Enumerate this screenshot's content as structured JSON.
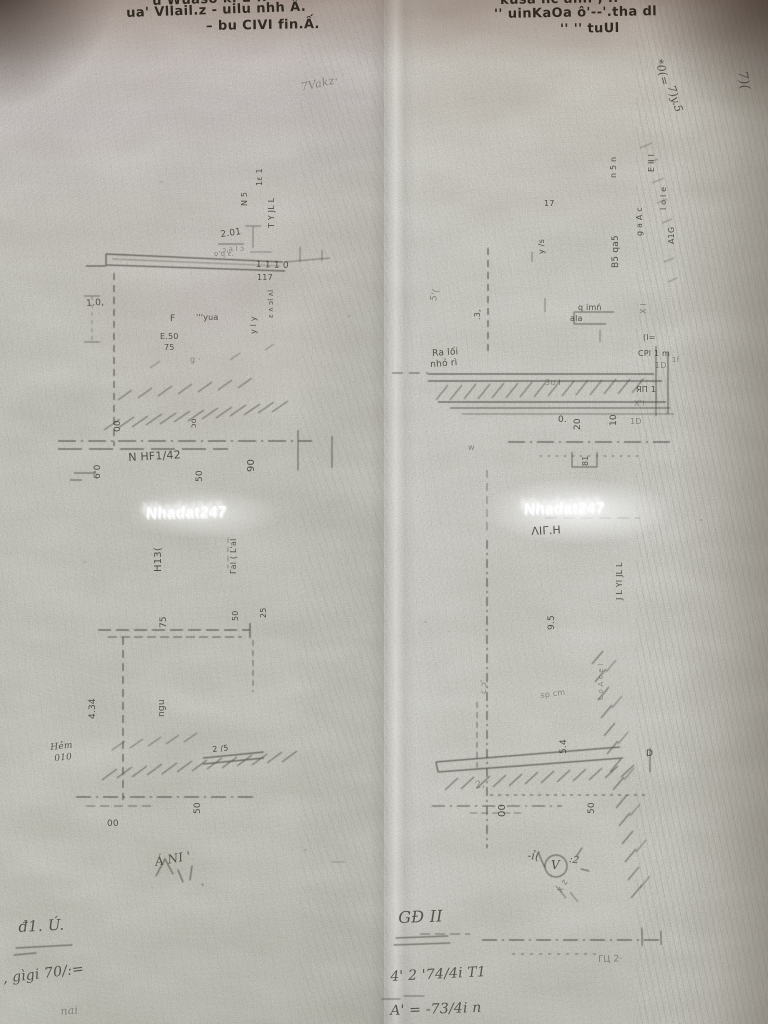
{
  "watermarks": {
    "left": "Nhadat247",
    "right": "Nhadat247"
  },
  "annotations": [
    {
      "name": "header-left-line1",
      "text": "u Wuaso k. 2 ..",
      "x": 152,
      "y": -5,
      "rot": -2,
      "fs": 13,
      "cls": "bold"
    },
    {
      "name": "header-left-line2",
      "text": "ua' Vllail.z - uilu nhh Â.",
      "x": 126,
      "y": 7,
      "rot": -2,
      "fs": 13,
      "cls": "bold"
    },
    {
      "name": "header-left-line3",
      "text": "– bu CIVI fin.Ấ.",
      "x": 206,
      "y": 20,
      "rot": -1,
      "fs": 13,
      "cls": "bold"
    },
    {
      "name": "header-right-line1",
      "text": "kusa nc ani. , ..",
      "x": 500,
      "y": -6,
      "rot": -1,
      "fs": 13,
      "cls": "bold"
    },
    {
      "name": "header-right-line2",
      "text": "'' uinKaOa ô'--'.tha dl",
      "x": 494,
      "y": 8,
      "rot": -1,
      "fs": 13,
      "cls": "bold"
    },
    {
      "name": "header-right-line3",
      "text": "'' '' tuUl",
      "x": 560,
      "y": 23,
      "rot": -1,
      "fs": 13,
      "cls": "bold"
    },
    {
      "name": "faint-scribble-top",
      "text": "7Vakz·",
      "x": 300,
      "y": 82,
      "rot": -12,
      "fs": 11,
      "cls": "hand faint"
    },
    {
      "name": "margin-note-1",
      "text": "*0(=",
      "x": 664,
      "y": 58,
      "rot": 75,
      "fs": 11,
      "cls": "hand"
    },
    {
      "name": "margin-note-2",
      "text": "7)y.5",
      "x": 676,
      "y": 84,
      "rot": 72,
      "fs": 11,
      "cls": "hand"
    },
    {
      "name": "margin-note-3",
      "text": "7)(",
      "x": 748,
      "y": 70,
      "rot": 80,
      "fs": 13,
      "cls": "hand"
    },
    {
      "name": "lt-col-1",
      "text": "1ɛ 1",
      "x": 256,
      "y": 186,
      "rot": -90,
      "fs": 8
    },
    {
      "name": "lt-col-2",
      "text": "T Y JL L",
      "x": 268,
      "y": 228,
      "rot": -90,
      "fs": 8
    },
    {
      "name": "lt-col-3",
      "text": "N 5",
      "x": 241,
      "y": 206,
      "rot": -90,
      "fs": 8
    },
    {
      "name": "lt-dim-201",
      "text": "2.01",
      "x": 220,
      "y": 231,
      "rot": -8,
      "fs": 9
    },
    {
      "name": "lt-mark-201u",
      "text": "ɔ,a l ɔ",
      "x": 222,
      "y": 247,
      "rot": -4,
      "fs": 7,
      "cls": "faint"
    },
    {
      "name": "lt-dim-1110",
      "text": "1 1 1 0",
      "x": 256,
      "y": 261,
      "rot": 2,
      "fs": 9
    },
    {
      "name": "lt-mark-117",
      "text": "117",
      "x": 257,
      "y": 274,
      "rot": 0,
      "fs": 8
    },
    {
      "name": "lt-col-4",
      "text": "ɛ ʌ ɔl ʌl",
      "x": 268,
      "y": 318,
      "rot": -90,
      "fs": 7
    },
    {
      "name": "lt-col-5",
      "text": "y l y",
      "x": 250,
      "y": 334,
      "rot": -90,
      "fs": 8
    },
    {
      "name": "lt-col-6",
      "text": "o'q ɛ.",
      "x": 214,
      "y": 251,
      "rot": 0,
      "fs": 7,
      "cls": "faint"
    },
    {
      "name": "lt-dim-10",
      "text": "1.0,",
      "x": 86,
      "y": 300,
      "rot": -4,
      "fs": 9
    },
    {
      "name": "lt-label-f",
      "text": "F",
      "x": 170,
      "y": 315,
      "rot": 0,
      "fs": 9
    },
    {
      "name": "lt-label-yua",
      "text": "'''yua",
      "x": 196,
      "y": 314,
      "rot": 0,
      "fs": 8
    },
    {
      "name": "lt-label-e50",
      "text": "E.50",
      "x": 160,
      "y": 333,
      "rot": 0,
      "fs": 8
    },
    {
      "name": "lt-label-75",
      "text": "75",
      "x": 164,
      "y": 344,
      "rot": 0,
      "fs": 8
    },
    {
      "name": "lt-mark-g",
      "text": "g ·",
      "x": 190,
      "y": 356,
      "rot": 0,
      "fs": 8,
      "cls": "faint"
    },
    {
      "name": "lt-dim-00",
      "text": "00",
      "x": 114,
      "y": 432,
      "rot": -90,
      "fs": 9
    },
    {
      "name": "lt-dim-oo",
      "text": "ɔo",
      "x": 190,
      "y": 428,
      "rot": -90,
      "fs": 8
    },
    {
      "name": "lt-dim-60",
      "text": "6'0",
      "x": 94,
      "y": 479,
      "rot": -90,
      "fs": 9
    },
    {
      "name": "lt-label-nhf",
      "text": "N HF1/42",
      "x": 128,
      "y": 452,
      "rot": -3,
      "fs": 11
    },
    {
      "name": "lt-dim-50",
      "text": "50",
      "x": 196,
      "y": 482,
      "rot": -90,
      "fs": 9
    },
    {
      "name": "lt-dim-90",
      "text": "90",
      "x": 247,
      "y": 472,
      "rot": -90,
      "fs": 10
    },
    {
      "name": "mid-col-glyphs",
      "text": "Γal ( L'al",
      "x": 230,
      "y": 574,
      "rot": -90,
      "fs": 8
    },
    {
      "name": "mid-label",
      "text": "H13(",
      "x": 154,
      "y": 572,
      "rot": -90,
      "fs": 10
    },
    {
      "name": "lb-dim-75",
      "text": "75",
      "x": 160,
      "y": 628,
      "rot": -90,
      "fs": 9
    },
    {
      "name": "lb-dim-50",
      "text": "50",
      "x": 232,
      "y": 621,
      "rot": -90,
      "fs": 8
    },
    {
      "name": "lb-dim-25",
      "text": "25",
      "x": 260,
      "y": 618,
      "rot": -90,
      "fs": 8
    },
    {
      "name": "lb-dim-434",
      "text": "4.34",
      "x": 89,
      "y": 719,
      "rot": -90,
      "fs": 9
    },
    {
      "name": "lb-room-label",
      "text": "ngu",
      "x": 158,
      "y": 717,
      "rot": -90,
      "fs": 9
    },
    {
      "name": "lb-mark-25",
      "text": "2 /5",
      "x": 212,
      "y": 746,
      "rot": -6,
      "fs": 8
    },
    {
      "name": "lb-dim-50b",
      "text": "50",
      "x": 194,
      "y": 814,
      "rot": -90,
      "fs": 9
    },
    {
      "name": "lb-dim-00b",
      "text": "00",
      "x": 107,
      "y": 820,
      "rot": 0,
      "fs": 9
    },
    {
      "name": "lb-hem-note-1",
      "text": "Hẻm",
      "x": 50,
      "y": 744,
      "rot": -6,
      "fs": 9,
      "cls": "hand"
    },
    {
      "name": "lb-hem-note-2",
      "text": "010",
      "x": 54,
      "y": 755,
      "rot": -6,
      "fs": 9,
      "cls": "hand"
    },
    {
      "name": "lb-sketch-note",
      "text": "Á NI '",
      "x": 154,
      "y": 856,
      "rot": -10,
      "fs": 12,
      "cls": "hand"
    },
    {
      "name": "rt-col-1",
      "text": "E il l",
      "x": 648,
      "y": 172,
      "rot": -90,
      "fs": 8
    },
    {
      "name": "rt-col-2",
      "text": "n 5 n",
      "x": 610,
      "y": 178,
      "rot": -90,
      "fs": 8
    },
    {
      "name": "rt-col-3",
      "text": "l o l e",
      "x": 660,
      "y": 210,
      "rot": -90,
      "fs": 8
    },
    {
      "name": "rt-col-4",
      "text": "g a A c",
      "x": 636,
      "y": 236,
      "rot": -90,
      "fs": 8
    },
    {
      "name": "rt-dim-b5",
      "text": "B5 qa5",
      "x": 612,
      "y": 268,
      "rot": -90,
      "fs": 9
    },
    {
      "name": "rt-col-5",
      "text": "A1G",
      "x": 668,
      "y": 244,
      "rot": -90,
      "fs": 8
    },
    {
      "name": "rt-dim-17",
      "text": "17",
      "x": 544,
      "y": 200,
      "rot": 0,
      "fs": 8
    },
    {
      "name": "rt-col-6",
      "text": "y /s",
      "x": 538,
      "y": 254,
      "rot": -90,
      "fs": 8
    },
    {
      "name": "rt-col-7",
      "text": "X l",
      "x": 640,
      "y": 314,
      "rot": -90,
      "fs": 8,
      "cls": "faint"
    },
    {
      "name": "rt-label-qimn",
      "text": "q imń",
      "x": 578,
      "y": 304,
      "rot": 0,
      "fs": 8
    },
    {
      "name": "rt-label-ala",
      "text": "ala",
      "x": 570,
      "y": 315,
      "rot": 0,
      "fs": 8
    },
    {
      "name": "rt-dim-3",
      "text": ".3,",
      "x": 474,
      "y": 320,
      "rot": -90,
      "fs": 8
    },
    {
      "name": "rt-mark-5",
      "text": "5'(",
      "x": 430,
      "y": 300,
      "rot": -75,
      "fs": 9,
      "cls": "faint"
    },
    {
      "name": "rt-raloi-note-1",
      "text": "Ra lối",
      "x": 432,
      "y": 350,
      "rot": -4,
      "fs": 9
    },
    {
      "name": "rt-raloi-note-2",
      "text": "nhỏ rì",
      "x": 430,
      "y": 361,
      "rot": -4,
      "fs": 9
    },
    {
      "name": "rt-mark-3ul",
      "text": "3u l",
      "x": 545,
      "y": 379,
      "rot": 0,
      "fs": 8,
      "cls": "faint"
    },
    {
      "name": "rt-dim-0",
      "text": "0.",
      "x": 558,
      "y": 416,
      "rot": 0,
      "fs": 9
    },
    {
      "name": "rt-dim-20",
      "text": "20",
      "x": 574,
      "y": 430,
      "rot": -90,
      "fs": 9
    },
    {
      "name": "rt-dim-10",
      "text": "10",
      "x": 610,
      "y": 426,
      "rot": -90,
      "fs": 9
    },
    {
      "name": "rt-glyph-cl",
      "text": "(l=",
      "x": 643,
      "y": 334,
      "rot": 0,
      "fs": 8
    },
    {
      "name": "rt-glyph-cpl",
      "text": "CPl 1 m",
      "x": 638,
      "y": 350,
      "rot": 0,
      "fs": 8
    },
    {
      "name": "rt-glyph-1d",
      "text": "1D",
      "x": 655,
      "y": 362,
      "rot": 0,
      "fs": 8,
      "cls": "faint"
    },
    {
      "name": "rt-glyph-rp",
      "text": "ЯП 1",
      "x": 636,
      "y": 386,
      "rot": 0,
      "fs": 8
    },
    {
      "name": "rt-glyph-xl",
      "text": "X'l",
      "x": 634,
      "y": 400,
      "rot": 0,
      "fs": 8,
      "cls": "faint"
    },
    {
      "name": "rt-glyph-1d2",
      "text": "1D",
      "x": 630,
      "y": 418,
      "rot": 0,
      "fs": 8,
      "cls": "faint"
    },
    {
      "name": "rt-glyph-1f",
      "text": "1ſ",
      "x": 672,
      "y": 357,
      "rot": 0,
      "fs": 7,
      "cls": "faint"
    },
    {
      "name": "rt-mark-w",
      "text": "w",
      "x": 468,
      "y": 444,
      "rot": 0,
      "fs": 8,
      "cls": "faint"
    },
    {
      "name": "rt-dim-81",
      "text": "81",
      "x": 582,
      "y": 466,
      "rot": -90,
      "fs": 8
    },
    {
      "name": "rb-room-label",
      "text": "ΛΙΓ.Η",
      "x": 531,
      "y": 526,
      "rot": -3,
      "fs": 11
    },
    {
      "name": "rb-dim-95",
      "text": "9.5",
      "x": 548,
      "y": 630,
      "rot": -90,
      "fs": 9
    },
    {
      "name": "rb-col-1",
      "text": "J L YI JL L",
      "x": 616,
      "y": 600,
      "rot": -90,
      "fs": 8
    },
    {
      "name": "rb-col-2",
      "text": "L o A c e l",
      "x": 598,
      "y": 700,
      "rot": -90,
      "fs": 7,
      "cls": "faint"
    },
    {
      "name": "rb-mark-co",
      "text": "c ɔ'",
      "x": 480,
      "y": 694,
      "rot": -90,
      "fs": 8,
      "cls": "faint"
    },
    {
      "name": "rb-mark-sp",
      "text": "sp cm",
      "x": 540,
      "y": 692,
      "rot": -8,
      "fs": 8,
      "cls": "faint"
    },
    {
      "name": "rb-dim-54",
      "text": "5.4",
      "x": 560,
      "y": 754,
      "rot": -90,
      "fs": 9
    },
    {
      "name": "rb-label-d",
      "text": "D",
      "x": 646,
      "y": 750,
      "rot": 0,
      "fs": 9
    },
    {
      "name": "rb-dim-00",
      "text": "00",
      "x": 498,
      "y": 817,
      "rot": -90,
      "fs": 10
    },
    {
      "name": "rb-dim-50",
      "text": "50",
      "x": 588,
      "y": 814,
      "rot": -90,
      "fs": 9
    },
    {
      "name": "rb-mark-2",
      "text": "2,",
      "x": 474,
      "y": 782,
      "rot": -15,
      "fs": 10,
      "cls": "hand faint"
    },
    {
      "name": "rb-mark-xz",
      "text": "x z",
      "x": 556,
      "y": 890,
      "rot": -60,
      "fs": 9,
      "cls": "faint"
    },
    {
      "name": "rb-mark-bottom",
      "text": "ΓЦ 2·",
      "x": 598,
      "y": 956,
      "rot": -2,
      "fs": 9,
      "cls": "faint"
    },
    {
      "name": "hw-tick",
      "text": "-ỉ(",
      "x": 528,
      "y": 850,
      "rot": 5,
      "fs": 11,
      "cls": "hand"
    },
    {
      "name": "hw-circle-v",
      "text": "V",
      "x": 551,
      "y": 859,
      "rot": 0,
      "fs": 12,
      "cls": "hand"
    },
    {
      "name": "hw-colon2",
      "text": ":2",
      "x": 570,
      "y": 855,
      "rot": 10,
      "fs": 10,
      "cls": "hand"
    },
    {
      "name": "hw-gd2",
      "text": "GĐ II",
      "x": 398,
      "y": 910,
      "rot": -2,
      "fs": 16,
      "cls": "hand"
    },
    {
      "name": "hw-num-line1",
      "text": "4' 2 '74/4i T1",
      "x": 390,
      "y": 970,
      "rot": -3,
      "fs": 14,
      "cls": "hand"
    },
    {
      "name": "hw-num-line2",
      "text": "A' = -73/4i n",
      "x": 390,
      "y": 1004,
      "rot": -2,
      "fs": 14,
      "cls": "hand"
    },
    {
      "name": "hw-d1u",
      "text": "đ1. Ú.",
      "x": 18,
      "y": 920,
      "rot": -3,
      "fs": 15,
      "cls": "hand"
    },
    {
      "name": "hw-gigi",
      "text": ", gìgi 70/:=",
      "x": 2,
      "y": 972,
      "rot": -7,
      "fs": 14,
      "cls": "hand"
    },
    {
      "name": "hw-nai",
      "text": "nai",
      "x": 60,
      "y": 1006,
      "rot": -5,
      "fs": 11,
      "cls": "hand faint"
    }
  ]
}
